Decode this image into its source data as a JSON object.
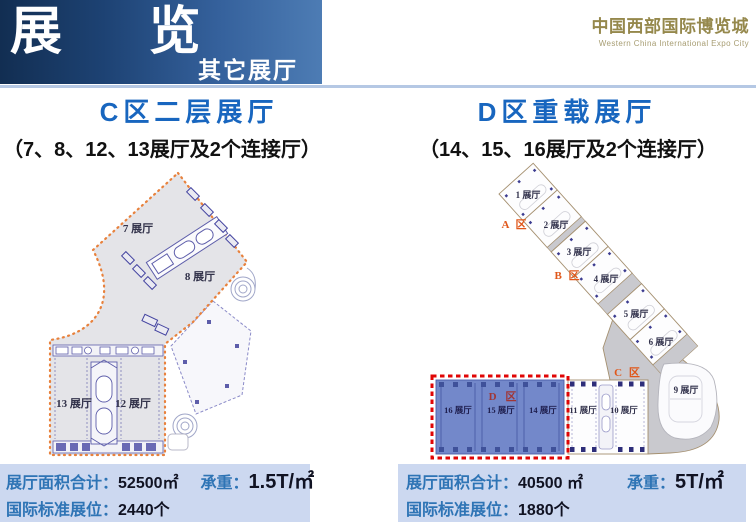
{
  "header": {
    "title": "展 览",
    "tab": "其它展厅",
    "logo_cn": "中国西部国际博览城",
    "logo_en": "Western China International  Expo City"
  },
  "c_section": {
    "title": "C区二层展厅",
    "subtitle": "（7、8、12、13展厅及2个连接厅）",
    "map": {
      "hall7": "7 展厅",
      "hall8": "8 展厅",
      "hall13": "13 展厅",
      "hall12": "12 展厅"
    },
    "stats": {
      "area_label": "展厅面积合计：",
      "area_value": "52500㎡",
      "load_label": "承重：",
      "load_value": "1.5T/㎡",
      "booth_label": "国际标准展位：",
      "booth_value": "2440个"
    }
  },
  "d_section": {
    "title": "D区重载展厅",
    "subtitle": "（14、15、16展厅及2个连接厅）",
    "map": {
      "hall1": "1 展厅",
      "hall2": "2 展厅",
      "hall3": "3 展厅",
      "hall4": "4 展厅",
      "hall5": "5 展厅",
      "hall6": "6 展厅",
      "hall9": "9 展厅",
      "hall10": "10 展厅",
      "hall11": "11 展厅",
      "hall14": "14 展厅",
      "hall15": "15 展厅",
      "hall16": "16 展厅",
      "zone_a": "A 区",
      "zone_b": "B 区",
      "zone_c": "C 区",
      "zone_d": "D 区"
    },
    "stats": {
      "area_label": "展厅面积合计：",
      "area_value": "40500 ㎡",
      "load_label": "承重：",
      "load_value": "5T/㎡",
      "booth_label": "国际标准展位：",
      "booth_value": "1880个"
    }
  },
  "colors": {
    "title_blue": "#1866bf",
    "label_blue": "#2e74b5",
    "bar_bg": "#ccd8f0",
    "banner_dark": "#122e52",
    "banner_light": "#4d7cb4",
    "map_orange": "#e8813c",
    "highlight_red": "#e00505",
    "dzone_fill": "#7388ca",
    "logo_gold": "#95884c"
  }
}
